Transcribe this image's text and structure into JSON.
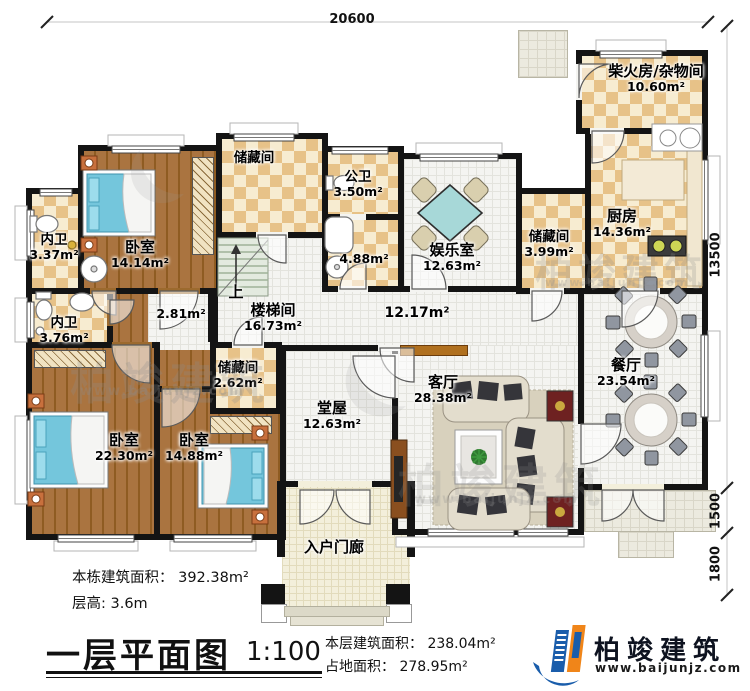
{
  "dimensions": {
    "top_width": "20600",
    "side_height": "13500",
    "porch_depth": "1500",
    "step_depth": "1800"
  },
  "rooms": {
    "chaihuofang": {
      "name": "柴火房/杂物间",
      "area": "10.60m²"
    },
    "chufang": {
      "name": "厨房",
      "area": "14.36m²"
    },
    "chucang_kitchen": {
      "name": "储藏间",
      "area": "3.99m²"
    },
    "chucang_top": {
      "name": "储藏间"
    },
    "gongwei": {
      "name": "公卫",
      "area": "3.50m²"
    },
    "yushi": {
      "area": "4.88m²"
    },
    "yuleshi": {
      "name": "娱乐室",
      "area": "12.63m²"
    },
    "woshi_a": {
      "name": "卧室",
      "area": "14.14m²"
    },
    "neiwei_a": {
      "name": "内卫",
      "area": "3.37m²"
    },
    "neiwei_b": {
      "name": "内卫",
      "area": "3.76m²"
    },
    "chucang_mid": {
      "name": "储藏间",
      "area": "2.62m²"
    },
    "woshi_b": {
      "name": "卧室",
      "area": "22.30m²"
    },
    "woshi_c": {
      "name": "卧室",
      "area": "14.88m²"
    },
    "loutijian": {
      "name": "楼梯间",
      "area": "16.73m²"
    },
    "corridor": {
      "area": "2.81m²"
    },
    "hall": {
      "area": "12.17m²"
    },
    "keting": {
      "name": "客厅",
      "area": "28.38m²"
    },
    "canting": {
      "name": "餐厅",
      "area": "23.54m²"
    },
    "tangwu": {
      "name": "堂屋",
      "area": "12.63m²"
    },
    "menlang": {
      "name": "入户门廊"
    },
    "stairs_up": "上"
  },
  "footer": {
    "building_area": "本栋建筑面积： 392.38m²",
    "floor_height": "层高: 3.6m",
    "title": "一层平面图",
    "scale": "1:100",
    "floor_area": "本层建筑面积： 238.04m²",
    "footprint": "占地面积： 278.95m²"
  },
  "logo": {
    "brand": "柏竣建筑",
    "site": "www.baijunjz.com"
  },
  "watermark": {
    "brand": "柏竣建筑",
    "site": "www.baijunjz.com"
  },
  "colors": {
    "wall": "#141414",
    "checker": "#e7c288",
    "wood": "#9c6a2e",
    "brand_blue": "#1a5dab",
    "brand_orange": "#f08519"
  }
}
